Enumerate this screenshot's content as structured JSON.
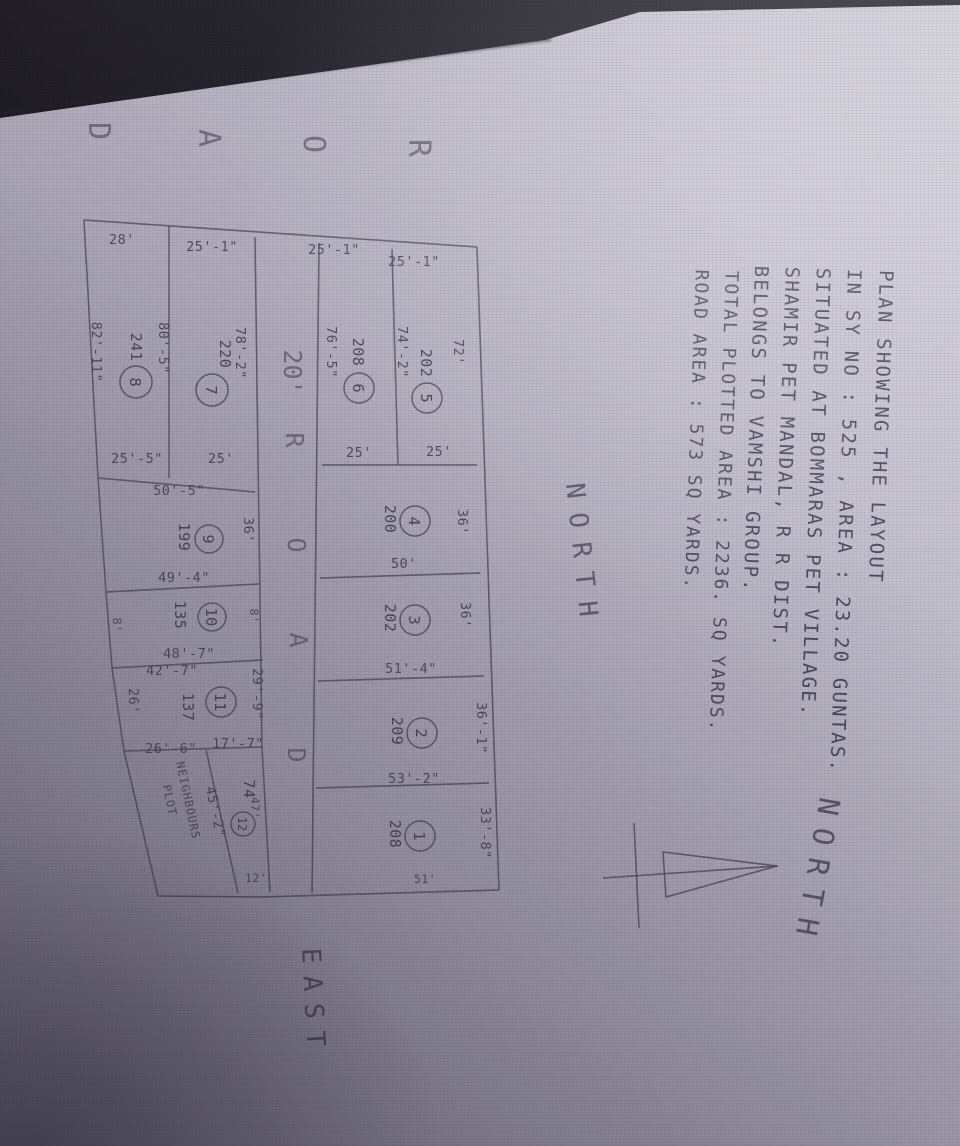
{
  "title_block": {
    "line1": "PLAN SHOWING THE LAYOUT",
    "line2": "IN SY NO : 525 , AREA : 23.20 GUNTAS.",
    "line3": "SITUATED AT BOMMARAS PET VILLAGE.",
    "line4": "SHAMIR PET MANDAL, R R DIST.",
    "line5": "BELONGS TO VAMSHI GROUP."
  },
  "area_summary": {
    "plotted": "TOTAL PLOTTED AREA : 2236. SQ YARDS.",
    "road": "ROAD AREA : 573 SQ YARDS."
  },
  "compass": {
    "label": "NORTH"
  },
  "direction_labels": {
    "north": "NORTH",
    "east": "EAST"
  },
  "west_road": {
    "letters": [
      "R",
      "O",
      "A",
      "D"
    ]
  },
  "internal_road": {
    "width_label": "20'",
    "letters": [
      "R",
      "O",
      "A",
      "D"
    ]
  },
  "plots": [
    {
      "number": "1",
      "area": "208",
      "dim_north": "33'-8\"",
      "dim_east": "51'"
    },
    {
      "number": "2",
      "area": "209",
      "dim_north": "36'-1\"",
      "dim_east": "53'-2\""
    },
    {
      "number": "3",
      "area": "202",
      "dim_north": "36'",
      "dim_east": "51'-4\""
    },
    {
      "number": "4",
      "area": "200",
      "dim_north": "36'",
      "dim_east": "50'"
    },
    {
      "number": "5",
      "area": "202",
      "dim_north": "72'",
      "dim_west": "25'-1\"",
      "dim_south": "74'-2\"",
      "dim_east": "25'"
    },
    {
      "number": "6",
      "area": "208",
      "dim_west": "25'-1\"",
      "dim_south": "76'-5\"",
      "dim_east": "25'"
    },
    {
      "number": "7",
      "area": "220",
      "dim_north": "78'-2\"",
      "dim_west": "25'-1\"",
      "dim_south": "80'-5\"",
      "dim_east": "25'"
    },
    {
      "number": "8",
      "area": "241",
      "dim_west": "28'",
      "dim_south": "82'-11\"",
      "dim_east": "25'-5\""
    },
    {
      "number": "9",
      "area": "199",
      "dim_north": "36'",
      "dim_west": "50'-5\"",
      "dim_east": "49'-4\""
    },
    {
      "number": "10",
      "area": "135",
      "dim_north": "8'",
      "dim_east": "48'-7\"",
      "dim_south": "8'"
    },
    {
      "number": "11",
      "area": "137",
      "dim_north": "29'-9\"",
      "dim_west": "42'-7\"",
      "dim_east_upper": "17'-7\"",
      "dim_east_lower": "26'-6\"",
      "dim_south": "26'"
    },
    {
      "number": "12",
      "area": "74",
      "dim_north": "47'",
      "dim_east": "12'",
      "dim_diagonal": "45'-2\""
    }
  ],
  "neighbours_plot": {
    "line1": "NEIGHBOURS",
    "line2": "PLOT"
  }
}
